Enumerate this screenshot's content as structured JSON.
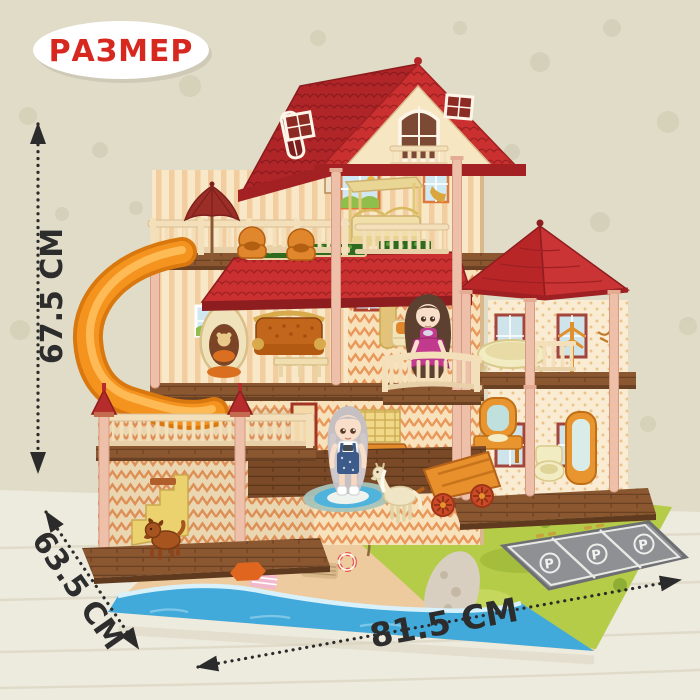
{
  "annotations": {
    "size_badge": "РАЗМЕР",
    "height_label": "67.5 СМ",
    "depth_label": "63.5 СМ",
    "width_label": "81.5 СМ"
  },
  "parking": {
    "spot_label": "P",
    "spot_count": 3
  },
  "colors": {
    "badge_bg": "#ffffff",
    "badge_text": "#d7281f",
    "arrow": "#2b2b2b",
    "roof_red": "#c9302f",
    "roof_dark": "#a32123",
    "awning_red": "#c22a2b",
    "slide_orange": "#f5931f",
    "wall_cream": "#f7e5c4",
    "stripe_peach": "#f2cd9f",
    "pillar_pink": "#eec0aa",
    "balustrade_cream": "#f3dfb9",
    "floor_brown": "#8a5731",
    "umbrella_maroon": "#9c2e28",
    "sofa_orange": "#c2661c",
    "mat_green": "#b5cc48",
    "sand_tan": "#eeca9f",
    "water_blue": "#41a9db",
    "parking_gray": "#8e9093",
    "doll_dress_magenta": "#c23a8e",
    "doll_overalls_blue": "#3c5a8a",
    "horse_cream": "#f0e5c4",
    "cart_orange": "#e8912c",
    "dog_brown": "#a8541f",
    "background_wall": "#e0dcc7",
    "table_wood": "#edeade"
  }
}
